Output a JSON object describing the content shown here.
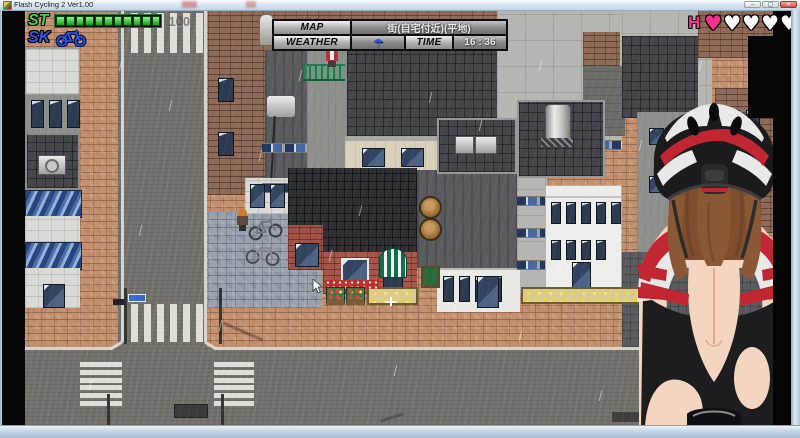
{
  "window": {
    "title": "Flash Cycling 2 Ver1.00",
    "minimize": "–",
    "maximize": "▢",
    "close": "✕"
  },
  "hud": {
    "stamina": {
      "label": "ST",
      "value": "100",
      "segments": 11
    },
    "skill": {
      "label": "SK"
    },
    "info": {
      "map_label": "MAP",
      "map_value": "街(自宅付近)(平地)",
      "weather_label": "WEATHER",
      "weather_icon": "☂",
      "time_label": "TIME",
      "time_value": "16 : 36"
    },
    "h_meter": {
      "label": "H",
      "glyph": "♥",
      "hearts_total": 5,
      "hearts_filled": 1
    }
  },
  "colors": {
    "stamina_green": "#3ed43e",
    "stamina_green_light": "#86f286",
    "stamina_green_dark": "#1d9b1d",
    "skill_blue": "#2d55e8",
    "heart_pink": "#ff2f92",
    "weather_blue": "#2d55e8"
  }
}
